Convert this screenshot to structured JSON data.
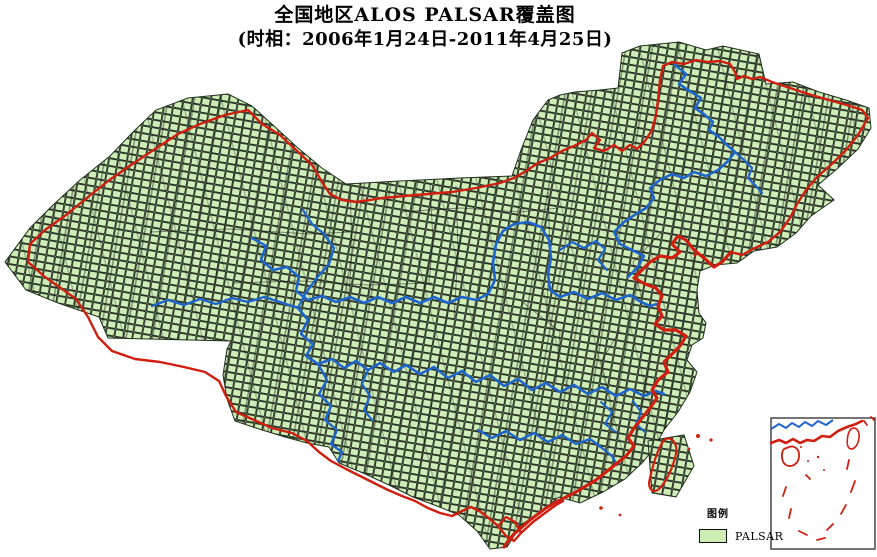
{
  "title": {
    "line1": "全国地区ALOS PALSAR覆盖图",
    "line2": "(时相：2006年1月24日-2011年4月25日)"
  },
  "legend": {
    "heading": "图例",
    "items": [
      {
        "label": "PALSAR"
      }
    ]
  },
  "colors": {
    "tile_fill": "#cdecb6",
    "tile_gap": "#7d9a6e",
    "tile_stroke": "#1c241c",
    "boundary_red": "#d01f10",
    "river_blue": "#1f66cc",
    "province_black": "#1a1a1a",
    "inset_frame": "#3a3a3a",
    "background": "#ffffff"
  }
}
